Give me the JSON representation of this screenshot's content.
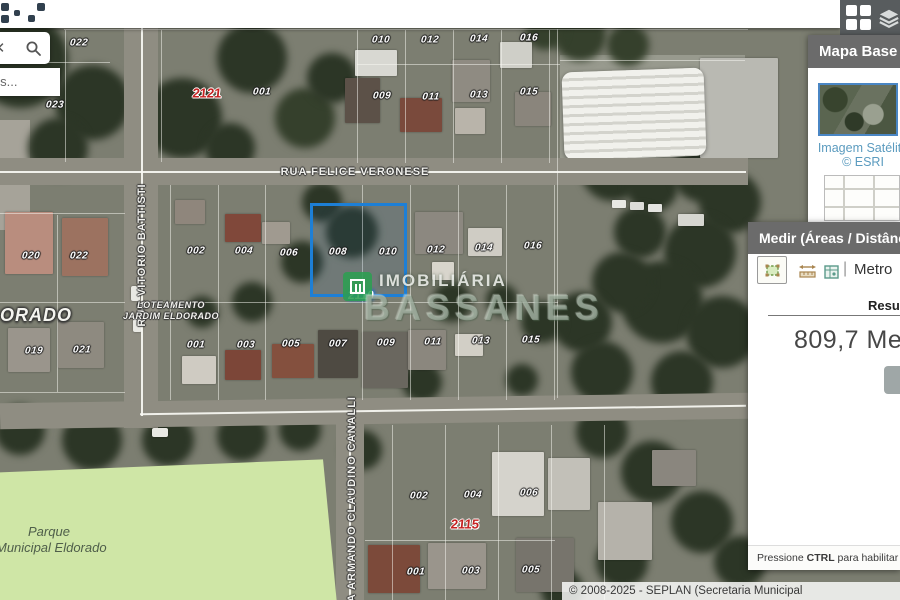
{
  "header": {
    "apps_icon": "grid-apps-icon",
    "layers_icon": "layers-icon"
  },
  "search": {
    "clear_glyph": "✕",
    "suggestion_text": "uis..."
  },
  "map": {
    "streets": [
      {
        "name": "RUA FELICE VERONESE"
      },
      {
        "name": "RUA VITORIO BATTISTI"
      },
      {
        "name": "RUA ARMANDO CLAUDINO CANALLI"
      }
    ],
    "area_label_line1": "LOTEAMENTO",
    "area_label_line2": "JARDIM ELDORADO",
    "big_area_label": "DORADO",
    "park_label_line1": "Parque",
    "park_label_line2": "Municipal Eldorado",
    "watermark": {
      "line1": "IMOBILIÁRIA",
      "line2": "BASSANES"
    },
    "selection_color": "#1d7fd6",
    "quadra_red": "#c52222",
    "park_green": "#cfe6a6",
    "labels": [
      {
        "t": "022",
        "x": 79,
        "y": 43,
        "k": "p"
      },
      {
        "t": "023",
        "x": 55,
        "y": 105,
        "k": "p"
      },
      {
        "t": "2121",
        "x": 207,
        "y": 93,
        "k": "qr"
      },
      {
        "t": "001",
        "x": 262,
        "y": 92,
        "k": "p"
      },
      {
        "t": "010",
        "x": 381,
        "y": 40,
        "k": "p"
      },
      {
        "t": "012",
        "x": 430,
        "y": 40,
        "k": "p"
      },
      {
        "t": "014",
        "x": 479,
        "y": 39,
        "k": "p"
      },
      {
        "t": "016",
        "x": 529,
        "y": 38,
        "k": "p"
      },
      {
        "t": "009",
        "x": 382,
        "y": 96,
        "k": "p"
      },
      {
        "t": "011",
        "x": 431,
        "y": 97,
        "k": "p"
      },
      {
        "t": "013",
        "x": 479,
        "y": 95,
        "k": "p"
      },
      {
        "t": "015",
        "x": 529,
        "y": 92,
        "k": "p"
      },
      {
        "t": "020",
        "x": 31,
        "y": 256,
        "k": "p"
      },
      {
        "t": "022",
        "x": 79,
        "y": 256,
        "k": "p"
      },
      {
        "t": "019",
        "x": 34,
        "y": 351,
        "k": "p"
      },
      {
        "t": "021",
        "x": 82,
        "y": 350,
        "k": "p"
      },
      {
        "t": "002",
        "x": 196,
        "y": 251,
        "k": "p"
      },
      {
        "t": "004",
        "x": 244,
        "y": 251,
        "k": "p"
      },
      {
        "t": "006",
        "x": 289,
        "y": 253,
        "k": "p"
      },
      {
        "t": "008",
        "x": 338,
        "y": 252,
        "k": "p"
      },
      {
        "t": "010",
        "x": 388,
        "y": 252,
        "k": "p"
      },
      {
        "t": "012",
        "x": 436,
        "y": 250,
        "k": "p"
      },
      {
        "t": "014",
        "x": 484,
        "y": 248,
        "k": "p"
      },
      {
        "t": "016",
        "x": 533,
        "y": 246,
        "k": "p"
      },
      {
        "t": "2110",
        "x": 361,
        "y": 295,
        "k": "qb"
      },
      {
        "t": "001",
        "x": 196,
        "y": 345,
        "k": "p"
      },
      {
        "t": "003",
        "x": 246,
        "y": 345,
        "k": "p"
      },
      {
        "t": "005",
        "x": 291,
        "y": 344,
        "k": "p"
      },
      {
        "t": "007",
        "x": 338,
        "y": 344,
        "k": "p"
      },
      {
        "t": "009",
        "x": 386,
        "y": 343,
        "k": "p"
      },
      {
        "t": "011",
        "x": 433,
        "y": 342,
        "k": "p"
      },
      {
        "t": "013",
        "x": 481,
        "y": 341,
        "k": "p"
      },
      {
        "t": "015",
        "x": 531,
        "y": 340,
        "k": "p"
      },
      {
        "t": "002",
        "x": 419,
        "y": 496,
        "k": "p"
      },
      {
        "t": "004",
        "x": 473,
        "y": 495,
        "k": "p"
      },
      {
        "t": "006",
        "x": 529,
        "y": 493,
        "k": "p"
      },
      {
        "t": "2115",
        "x": 465,
        "y": 524,
        "k": "qr"
      },
      {
        "t": "001",
        "x": 416,
        "y": 572,
        "k": "p"
      },
      {
        "t": "003",
        "x": 471,
        "y": 571,
        "k": "p"
      },
      {
        "t": "005",
        "x": 531,
        "y": 570,
        "k": "p"
      }
    ]
  },
  "basemap_panel": {
    "title": "Mapa Base",
    "selected_label_line1": "Imagem Satélite",
    "selected_label_line2": "© ESRI"
  },
  "measure_panel": {
    "title": "Medir (Áreas / Distânci",
    "separator": "|",
    "unit_label": "Metro",
    "result_label": "Result",
    "result_value": "809,7 Metr",
    "hint_prefix": "Pressione ",
    "hint_key": "CTRL",
    "hint_suffix": " para habilitar o ajuste"
  },
  "attribution": "© 2008-2025 - SEPLAN (Secretaria Municipal"
}
